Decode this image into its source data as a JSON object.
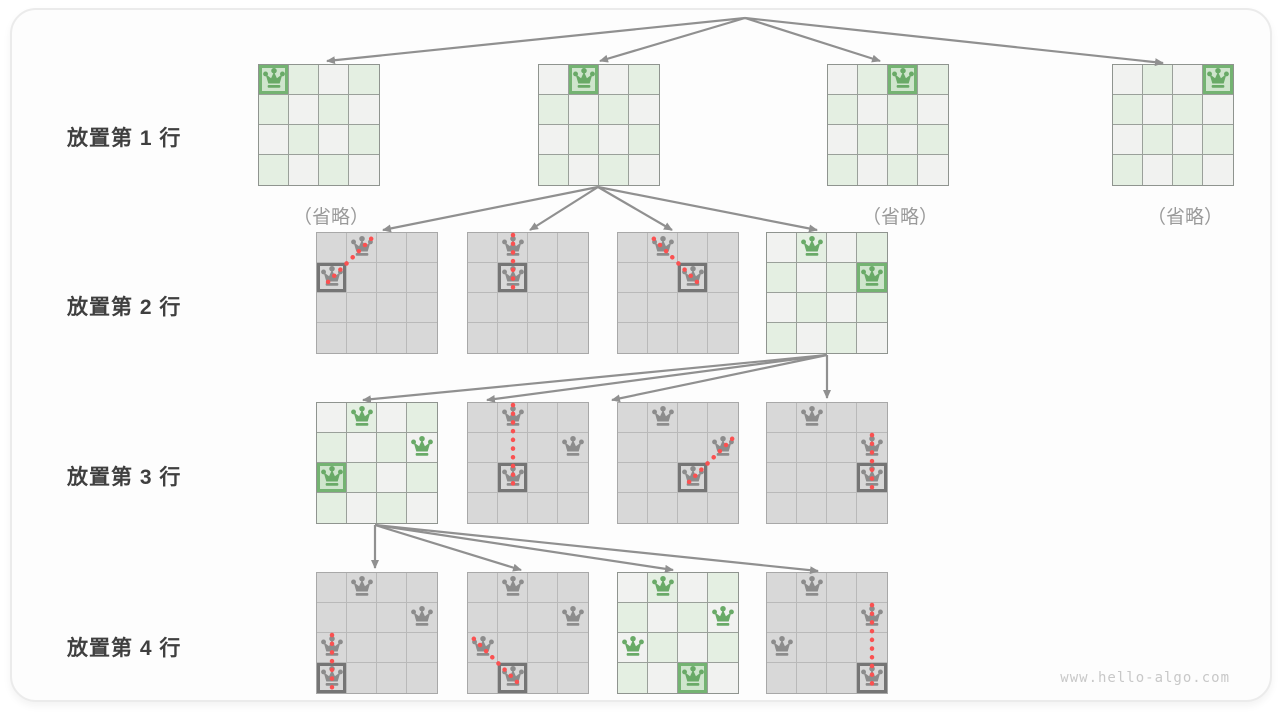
{
  "page": {
    "watermark": "www.hello-algo.com"
  },
  "colors": {
    "green": "#69aa67",
    "green_border": "#74b372",
    "green_cell": "#e4efe2",
    "green_placed": "#cfe5cd",
    "neutral_cell": "#f1f2f0",
    "gray_cell": "#d8d8d8",
    "gray_queen": "#8c8c8c",
    "gray_border": "#757575",
    "arrow": "#909090",
    "conflict_red": "#fa5151"
  },
  "rows": [
    {
      "label": "放置第 1 行",
      "boards": [
        {
          "x": 258,
          "y": 64,
          "theme": "green",
          "queens": [
            {
              "r": 0,
              "c": 0,
              "placed": true
            }
          ],
          "caption": "（省略）"
        },
        {
          "x": 538,
          "y": 64,
          "theme": "green",
          "queens": [
            {
              "r": 0,
              "c": 1,
              "placed": true
            }
          ]
        },
        {
          "x": 827,
          "y": 64,
          "theme": "green",
          "queens": [
            {
              "r": 0,
              "c": 2,
              "placed": true
            }
          ],
          "caption": "（省略）"
        },
        {
          "x": 1112,
          "y": 64,
          "theme": "green",
          "queens": [
            {
              "r": 0,
              "c": 3,
              "placed": true
            }
          ],
          "caption": "（省略）"
        }
      ]
    },
    {
      "label": "放置第 2 行",
      "boards": [
        {
          "x": 316,
          "y": 232,
          "theme": "gray",
          "queens": [
            {
              "r": 0,
              "c": 1
            },
            {
              "r": 1,
              "c": 0,
              "placed": true
            }
          ],
          "conflict": {
            "from": [
              0,
              1
            ],
            "to": [
              1,
              0
            ]
          }
        },
        {
          "x": 467,
          "y": 232,
          "theme": "gray",
          "queens": [
            {
              "r": 0,
              "c": 1
            },
            {
              "r": 1,
              "c": 1,
              "placed": true
            }
          ],
          "conflict": {
            "from": [
              0,
              1
            ],
            "to": [
              1,
              1
            ]
          }
        },
        {
          "x": 617,
          "y": 232,
          "theme": "gray",
          "queens": [
            {
              "r": 0,
              "c": 1
            },
            {
              "r": 1,
              "c": 2,
              "placed": true
            }
          ],
          "conflict": {
            "from": [
              0,
              1
            ],
            "to": [
              1,
              2
            ]
          }
        },
        {
          "x": 766,
          "y": 232,
          "theme": "green",
          "queens": [
            {
              "r": 0,
              "c": 1
            },
            {
              "r": 1,
              "c": 3,
              "placed": true
            }
          ]
        }
      ]
    },
    {
      "label": "放置第 3 行",
      "boards": [
        {
          "x": 316,
          "y": 402,
          "theme": "green",
          "queens": [
            {
              "r": 0,
              "c": 1
            },
            {
              "r": 1,
              "c": 3
            },
            {
              "r": 2,
              "c": 0,
              "placed": true
            }
          ]
        },
        {
          "x": 467,
          "y": 402,
          "theme": "gray",
          "queens": [
            {
              "r": 0,
              "c": 1
            },
            {
              "r": 1,
              "c": 3
            },
            {
              "r": 2,
              "c": 1,
              "placed": true
            }
          ],
          "conflict": {
            "from": [
              0,
              1
            ],
            "to": [
              2,
              1
            ]
          }
        },
        {
          "x": 617,
          "y": 402,
          "theme": "gray",
          "queens": [
            {
              "r": 0,
              "c": 1
            },
            {
              "r": 1,
              "c": 3
            },
            {
              "r": 2,
              "c": 2,
              "placed": true
            }
          ],
          "conflict": {
            "from": [
              1,
              3
            ],
            "to": [
              2,
              2
            ]
          }
        },
        {
          "x": 766,
          "y": 402,
          "theme": "gray",
          "queens": [
            {
              "r": 0,
              "c": 1
            },
            {
              "r": 1,
              "c": 3
            },
            {
              "r": 2,
              "c": 3,
              "placed": true
            }
          ],
          "conflict": {
            "from": [
              1,
              3
            ],
            "to": [
              2,
              3
            ]
          }
        }
      ]
    },
    {
      "label": "放置第 4 行",
      "boards": [
        {
          "x": 316,
          "y": 572,
          "theme": "gray",
          "queens": [
            {
              "r": 0,
              "c": 1
            },
            {
              "r": 1,
              "c": 3
            },
            {
              "r": 2,
              "c": 0
            },
            {
              "r": 3,
              "c": 0,
              "placed": true
            }
          ],
          "conflict": {
            "from": [
              2,
              0
            ],
            "to": [
              3,
              0
            ]
          }
        },
        {
          "x": 467,
          "y": 572,
          "theme": "gray",
          "queens": [
            {
              "r": 0,
              "c": 1
            },
            {
              "r": 1,
              "c": 3
            },
            {
              "r": 2,
              "c": 0
            },
            {
              "r": 3,
              "c": 1,
              "placed": true
            }
          ],
          "conflict": {
            "from": [
              2,
              0
            ],
            "to": [
              3,
              1
            ]
          }
        },
        {
          "x": 617,
          "y": 572,
          "theme": "green",
          "queens": [
            {
              "r": 0,
              "c": 1
            },
            {
              "r": 1,
              "c": 3
            },
            {
              "r": 2,
              "c": 0
            },
            {
              "r": 3,
              "c": 2,
              "placed": true
            }
          ]
        },
        {
          "x": 766,
          "y": 572,
          "theme": "gray",
          "queens": [
            {
              "r": 0,
              "c": 1
            },
            {
              "r": 1,
              "c": 3
            },
            {
              "r": 2,
              "c": 0
            },
            {
              "r": 3,
              "c": 3,
              "placed": true
            }
          ],
          "conflict": {
            "from": [
              1,
              3
            ],
            "to": [
              3,
              3
            ]
          }
        }
      ]
    }
  ],
  "edges": [
    {
      "x1": 745,
      "y1": 18,
      "x2": 327,
      "y2": 61
    },
    {
      "x1": 745,
      "y1": 18,
      "x2": 600,
      "y2": 61
    },
    {
      "x1": 745,
      "y1": 18,
      "x2": 880,
      "y2": 61
    },
    {
      "x1": 745,
      "y1": 18,
      "x2": 1163,
      "y2": 63
    },
    {
      "x1": 598,
      "y1": 187,
      "x2": 383,
      "y2": 230
    },
    {
      "x1": 598,
      "y1": 187,
      "x2": 530,
      "y2": 230
    },
    {
      "x1": 598,
      "y1": 187,
      "x2": 672,
      "y2": 230
    },
    {
      "x1": 598,
      "y1": 187,
      "x2": 817,
      "y2": 230
    },
    {
      "x1": 827,
      "y1": 355,
      "x2": 363,
      "y2": 400
    },
    {
      "x1": 827,
      "y1": 355,
      "x2": 487,
      "y2": 400
    },
    {
      "x1": 827,
      "y1": 355,
      "x2": 612,
      "y2": 400
    },
    {
      "x1": 827,
      "y1": 355,
      "x2": 827,
      "y2": 398
    },
    {
      "x1": 375,
      "y1": 525,
      "x2": 375,
      "y2": 568
    },
    {
      "x1": 375,
      "y1": 525,
      "x2": 521,
      "y2": 570
    },
    {
      "x1": 375,
      "y1": 525,
      "x2": 673,
      "y2": 570
    },
    {
      "x1": 375,
      "y1": 525,
      "x2": 818,
      "y2": 571
    }
  ]
}
